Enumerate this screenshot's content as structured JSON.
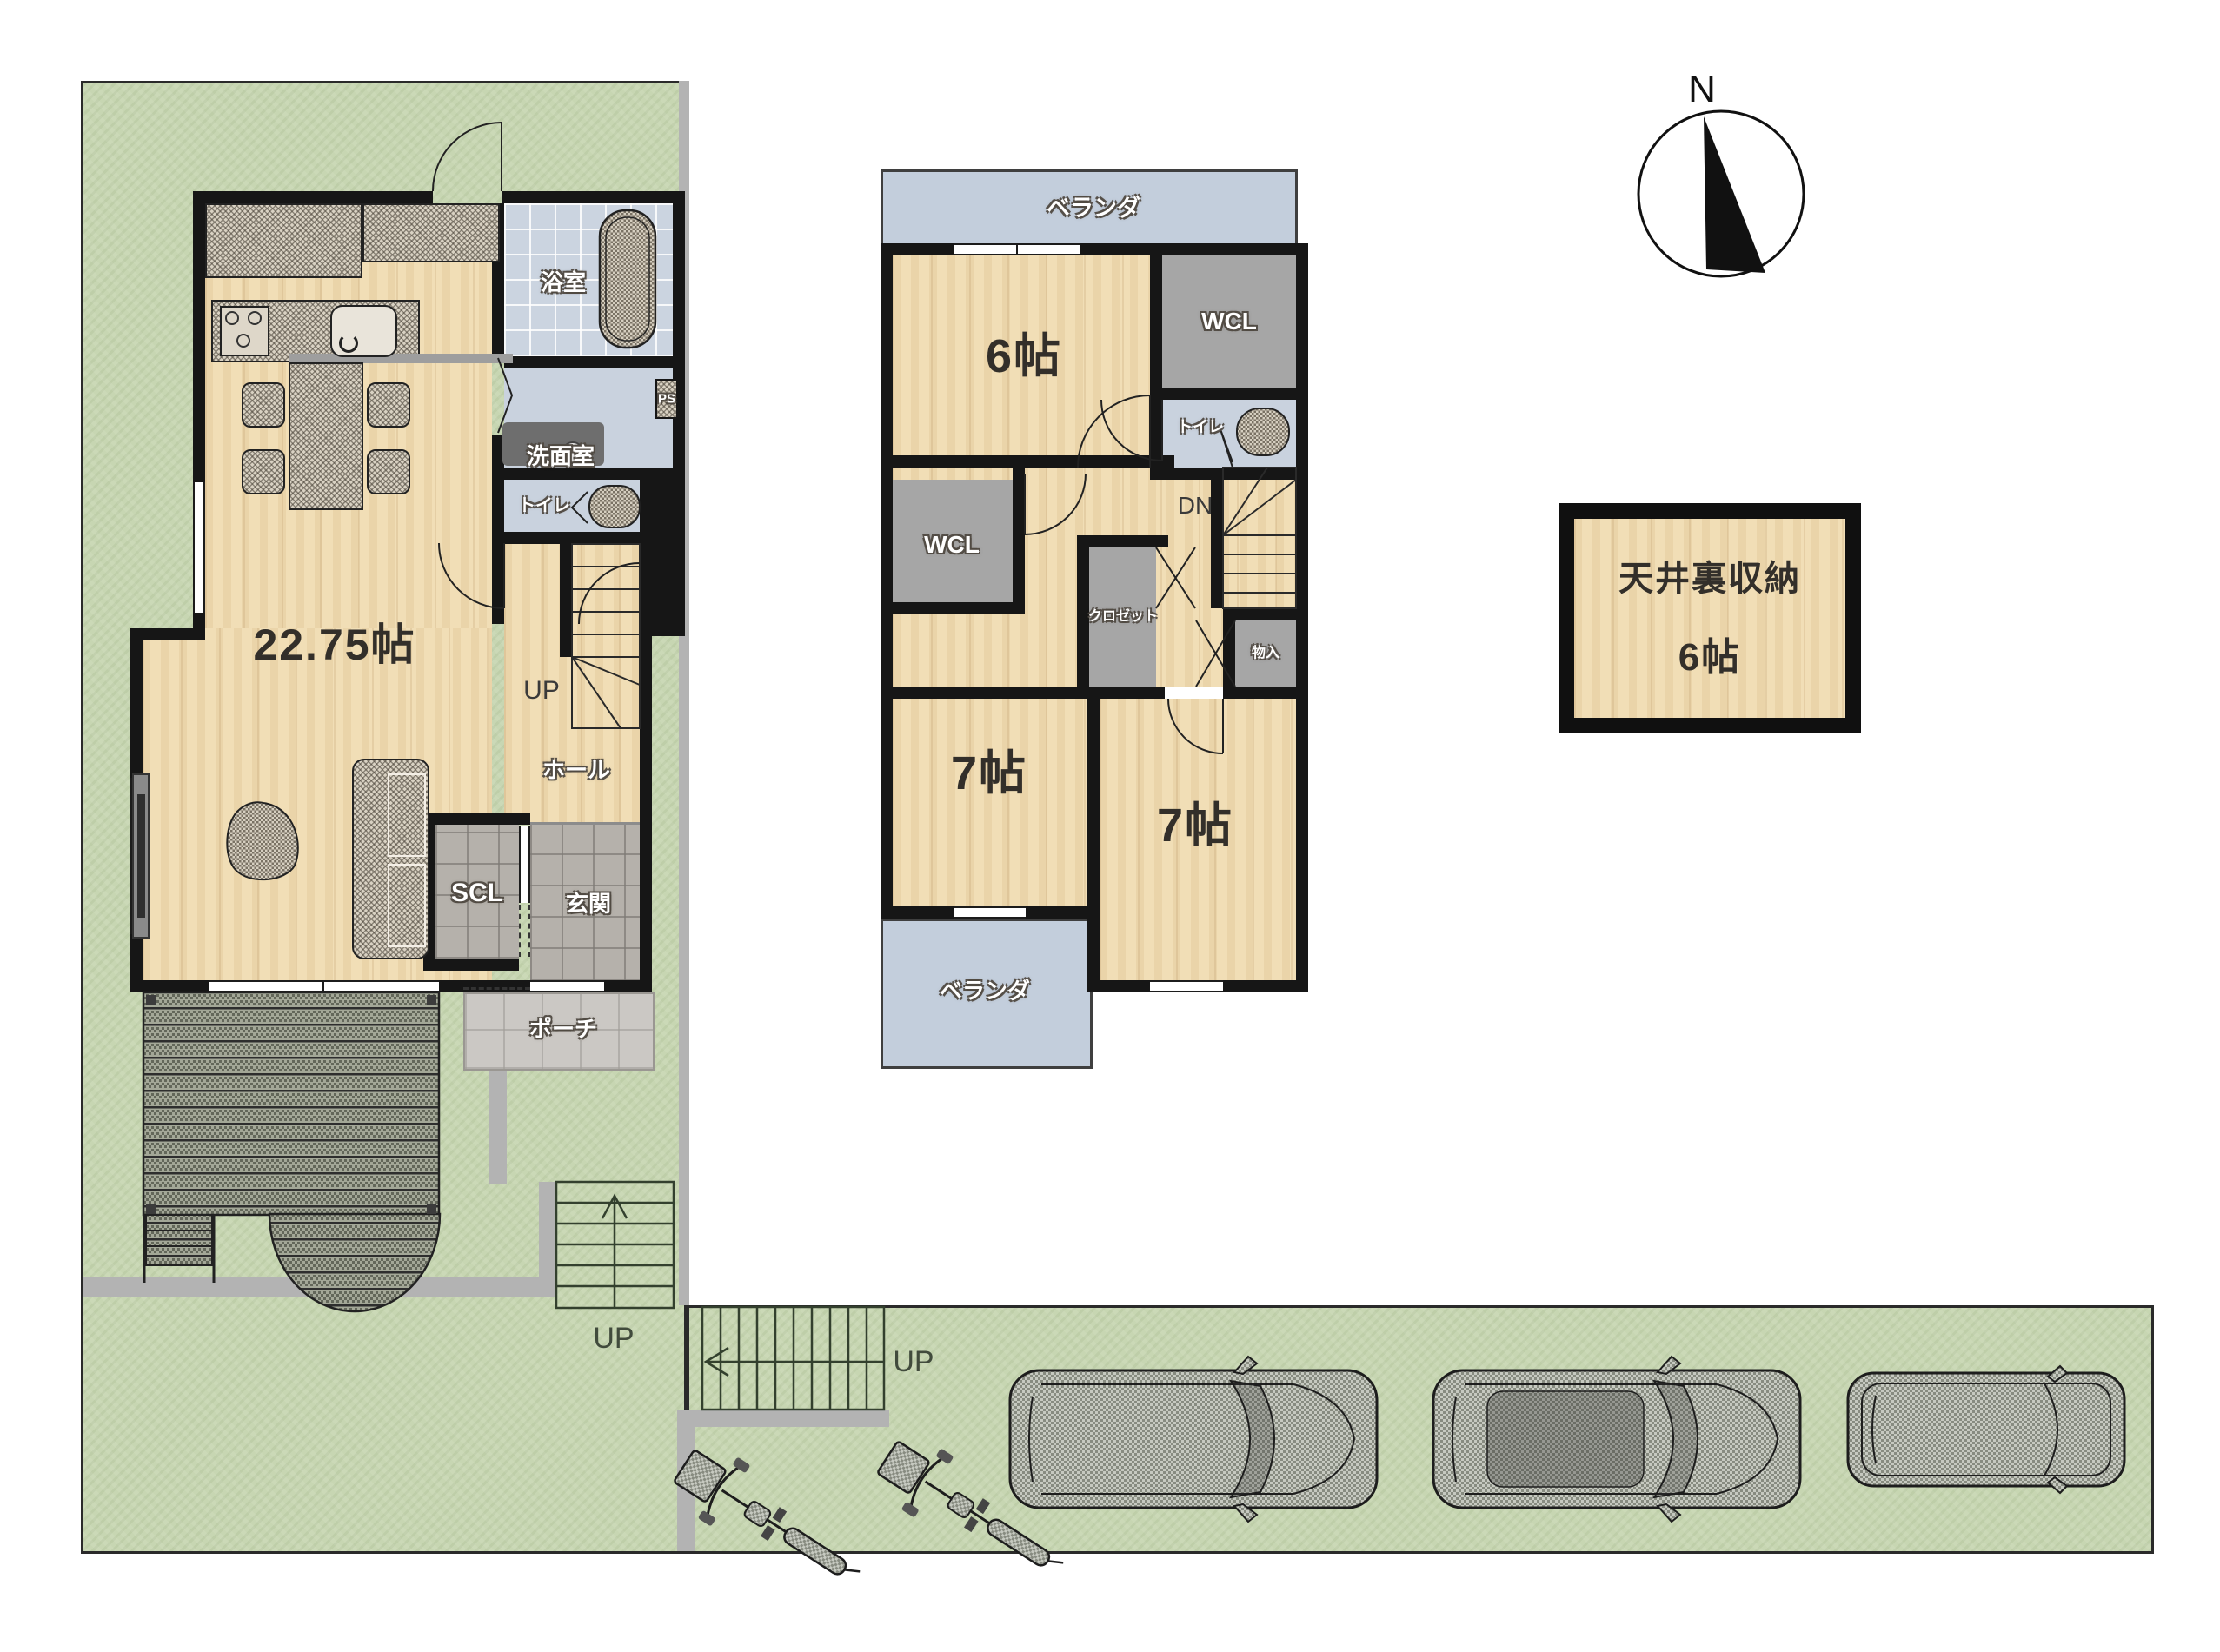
{
  "colors": {
    "grass": "#c7d6b2",
    "wood_floor": "#f1deb6",
    "wall": "#161616",
    "wet_room": "#c9d2de",
    "bath_tile": "#cbd4e0",
    "gray_storage": "#a6a6a6",
    "entrance_tile": "#b5b1ab",
    "porch_tile": "#cbc8c4",
    "veranda": "#c3cedc",
    "furniture_hatch": "#d9d2c3",
    "deck": "#a3a797",
    "path_gray": "#b3b3b3"
  },
  "floor1": {
    "ldk_size": "22.75帖",
    "bath": "浴室",
    "washroom": "洗面室",
    "pipe_space": "PS",
    "toilet": "トイレ",
    "stairs_up": "UP",
    "hall": "ホール",
    "shoes_closet": "SCL",
    "entrance": "玄関",
    "porch": "ポーチ"
  },
  "floor2": {
    "veranda_top": "ベランダ",
    "bedroom_6": "6帖",
    "wcl_upper": "WCL",
    "toilet": "トイレ",
    "stairs_down": "DN",
    "wcl_lower": "WCL",
    "closet": "クロゼット",
    "storage": "物入",
    "bedroom_7_left": "7帖",
    "bedroom_7_right": "7帖",
    "veranda_bottom": "ベランダ"
  },
  "attic": {
    "name": "天井裏収納",
    "size": "6帖"
  },
  "site": {
    "compass_north": "N",
    "garden_stairs_up": "UP",
    "street_stairs_up": "UP"
  }
}
